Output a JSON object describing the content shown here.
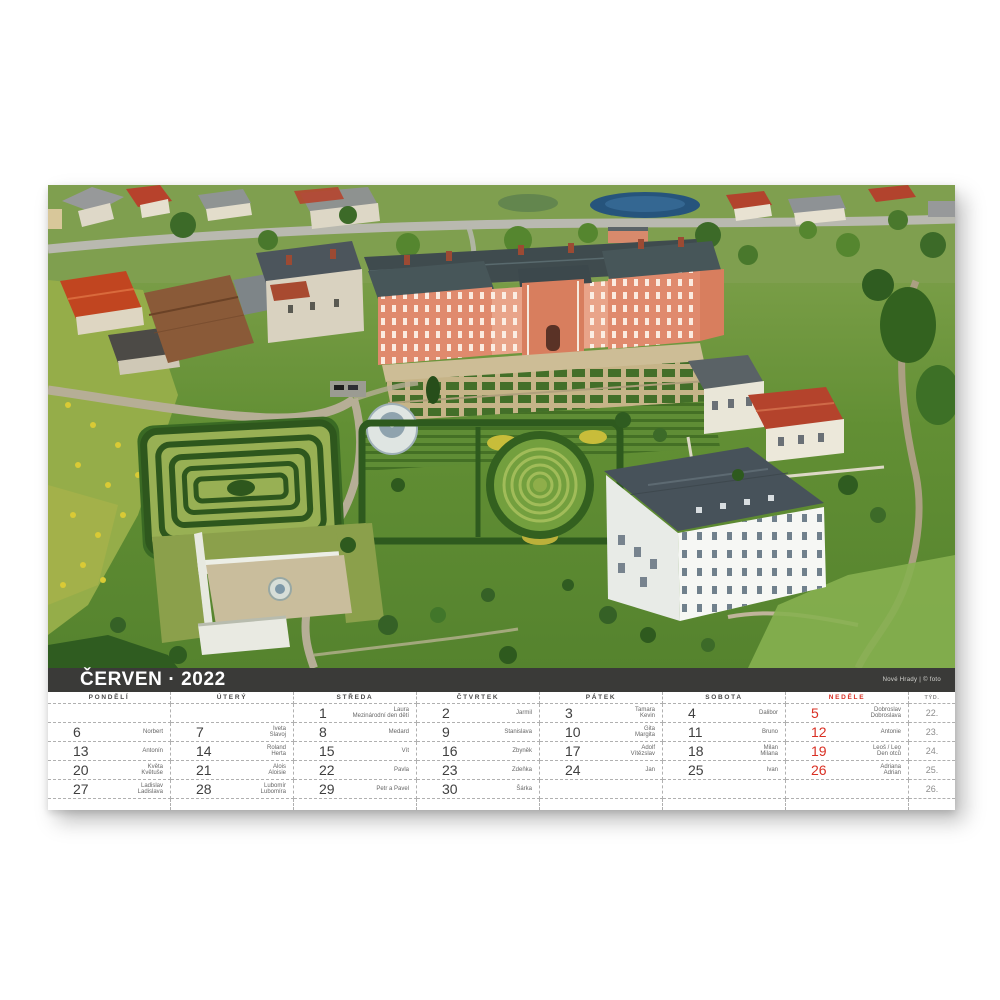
{
  "sheet": {
    "title": "ČERVEN · 2022",
    "photo_credit": "Nové Hrady | © foto"
  },
  "calendar": {
    "week_col_header": "TÝD.",
    "day_headers": [
      {
        "label": "PONDĚLÍ",
        "red": false
      },
      {
        "label": "ÚTERÝ",
        "red": false
      },
      {
        "label": "STŘEDA",
        "red": false
      },
      {
        "label": "ČTVRTEK",
        "red": false
      },
      {
        "label": "PÁTEK",
        "red": false
      },
      {
        "label": "SOBOTA",
        "red": false
      },
      {
        "label": "NEDĚLE",
        "red": true
      }
    ],
    "weeks": [
      {
        "week": "22.",
        "days": [
          null,
          null,
          {
            "num": "1",
            "names": [
              "Laura",
              "Mezinárodní den dětí"
            ]
          },
          {
            "num": "2",
            "names": [
              "Jarmil"
            ]
          },
          {
            "num": "3",
            "names": [
              "Tamara",
              "Kevin"
            ]
          },
          {
            "num": "4",
            "names": [
              "Dalibor"
            ]
          },
          {
            "num": "5",
            "names": [
              "Dobroslav",
              "Dobroslava"
            ]
          }
        ]
      },
      {
        "week": "23.",
        "days": [
          {
            "num": "6",
            "names": [
              "Norbert"
            ]
          },
          {
            "num": "7",
            "names": [
              "Iveta",
              "Slavoj"
            ]
          },
          {
            "num": "8",
            "names": [
              "Medard"
            ]
          },
          {
            "num": "9",
            "names": [
              "Stanislava"
            ]
          },
          {
            "num": "10",
            "names": [
              "Gita",
              "Margita"
            ]
          },
          {
            "num": "11",
            "names": [
              "Bruno"
            ]
          },
          {
            "num": "12",
            "names": [
              "Antonie"
            ]
          }
        ]
      },
      {
        "week": "24.",
        "days": [
          {
            "num": "13",
            "names": [
              "Antonín"
            ]
          },
          {
            "num": "14",
            "names": [
              "Roland",
              "Herta"
            ]
          },
          {
            "num": "15",
            "names": [
              "Vít"
            ]
          },
          {
            "num": "16",
            "names": [
              "Zbyněk"
            ]
          },
          {
            "num": "17",
            "names": [
              "Adolf",
              "Vítězslav"
            ]
          },
          {
            "num": "18",
            "names": [
              "Milan",
              "Milana"
            ]
          },
          {
            "num": "19",
            "names": [
              "Leoš / Leo",
              "Den otců"
            ]
          }
        ]
      },
      {
        "week": "25.",
        "days": [
          {
            "num": "20",
            "names": [
              "Květa",
              "Květuše"
            ]
          },
          {
            "num": "21",
            "names": [
              "Alois",
              "Aloisie"
            ]
          },
          {
            "num": "22",
            "names": [
              "Pavla"
            ]
          },
          {
            "num": "23",
            "names": [
              "Zdeňka"
            ]
          },
          {
            "num": "24",
            "names": [
              "Jan"
            ]
          },
          {
            "num": "25",
            "names": [
              "Ivan"
            ]
          },
          {
            "num": "26",
            "names": [
              "Adriana",
              "Adrian"
            ]
          }
        ]
      },
      {
        "week": "26.",
        "days": [
          {
            "num": "27",
            "names": [
              "Ladislav",
              "Ladislava"
            ]
          },
          {
            "num": "28",
            "names": [
              "Lubomír",
              "Lubomíra"
            ]
          },
          {
            "num": "29",
            "names": [
              "Petr a Pavel"
            ]
          },
          {
            "num": "30",
            "names": [
              "Šárka"
            ]
          },
          null,
          null,
          null
        ]
      }
    ],
    "colors": {
      "accent_red": "#d92f23",
      "title_bar": "#3a3a38"
    }
  }
}
